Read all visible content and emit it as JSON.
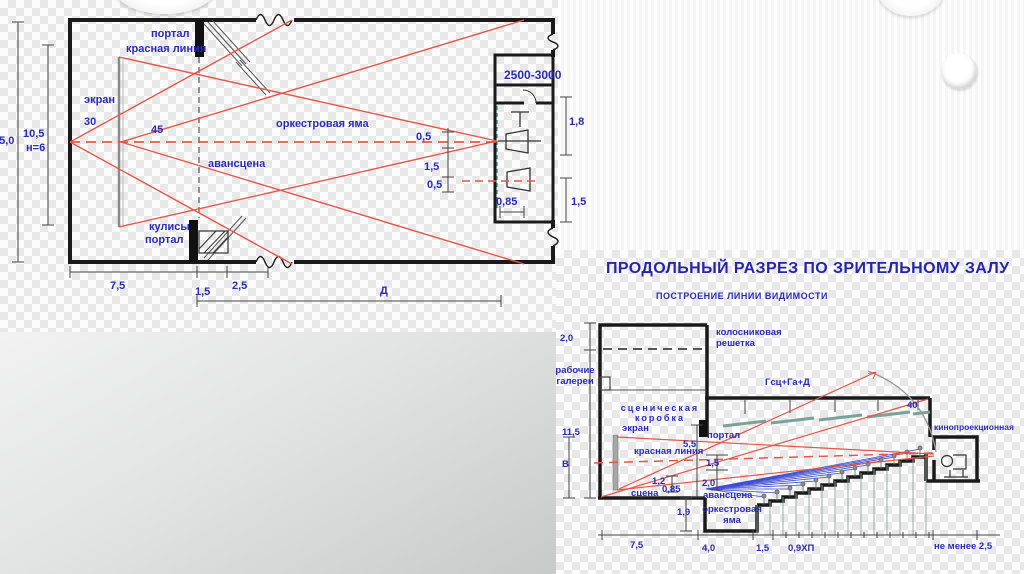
{
  "title_block": {
    "title": "ПРОДОЛЬНЫЙ  РАЗРЕЗ ПО ЗРИТЕЛЬНОМУ ЗАЛУ",
    "subtitle": "ПОСТРОЕНИЕ  ЛИНИИ ВИДИМОСТИ"
  },
  "colors": {
    "label_blue": "#2b2bb4",
    "sight_line_red": "#e2574a",
    "sight_line_blue": "#2b3bd0",
    "wall_black": "#1a1a1a",
    "panel_teal": "#79a39a"
  },
  "plan": {
    "labels": {
      "portal": "портал",
      "red_line": "красная линия",
      "screen": "экран",
      "angle_30": "30",
      "angle_45": "45",
      "orchestra_pit": "оркестровая яма",
      "forestage": "авансцена",
      "wings": "кулисы",
      "wings_portal": "портал",
      "booth_width": "2500-3000",
      "dim_0_5_upper": "0,5",
      "dim_1_5_mid": "1,5",
      "dim_0_5_lower": "0,5",
      "dim_1_8": "1,8",
      "dim_0_85": "0,85",
      "dim_1_5_right": "1,5",
      "dim_15_0": "15,0",
      "dim_10_5": "10,5",
      "dim_h_6": "н=6",
      "dim_7_5": "7,5",
      "dim_1_5_bottom": "1,5",
      "dim_2_5": "2,5",
      "dim_depth": "Д"
    }
  },
  "section": {
    "labels": {
      "grid": "колосниковая решетка",
      "dim_2_0": "2,0",
      "galleries": "рабочие галереи",
      "stage_box": "сценическая коробка",
      "dim_11_5": "11,5",
      "screen": "экран",
      "portal": "портал",
      "dim_5_5": "5,5",
      "red_line": "красная линия",
      "dim_b": "В",
      "dim_1_5": "1,5",
      "dim_1_2": "1,2",
      "dim_0_85": "0,85",
      "dim_2_0_b": "2,0",
      "stage": "сцена",
      "forestage": "авансцена",
      "dim_1_9": "1,9",
      "orchestra_pit": "оркестровая яма",
      "ceiling_formula": "Гсц+Га+Д",
      "angle_40": "40",
      "projection_room": "кинопроекционная",
      "dim_7_5": "7,5",
      "dim_4_0": "4,0",
      "dim_1_5_b": "1,5",
      "dim_row": "0,9ХП",
      "dim_min": "не менее 2,5"
    }
  }
}
